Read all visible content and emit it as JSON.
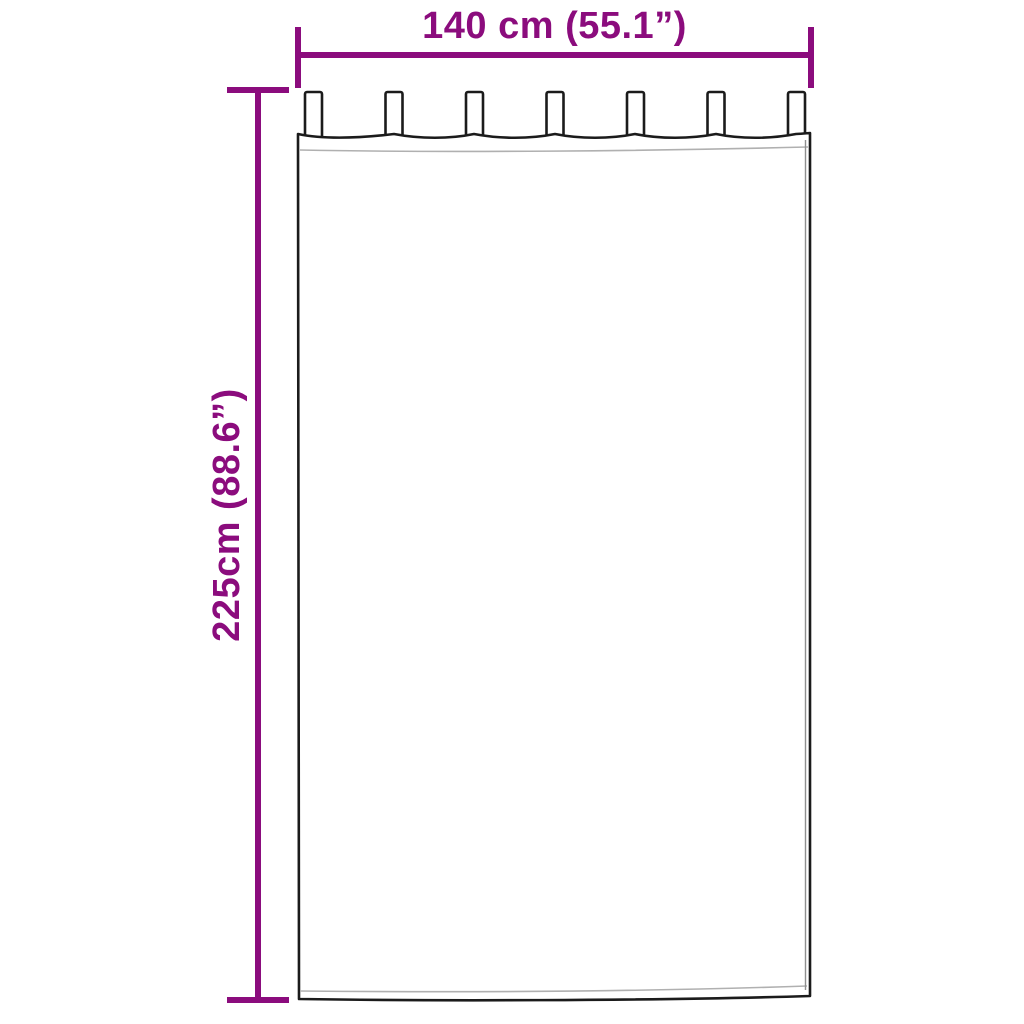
{
  "dimensions": {
    "width": {
      "label": "140 cm (55.1”)"
    },
    "height": {
      "label": "225cm (88.6”)"
    }
  },
  "curtain": {
    "description": "tab-top curtain line drawing",
    "tab_count": 7
  },
  "colors": {
    "dimension_accent": "#8B0C7D",
    "drawing_outline": "#1B1B1B",
    "hem_line": "#B0B0B0",
    "background": "#FFFFFF"
  }
}
